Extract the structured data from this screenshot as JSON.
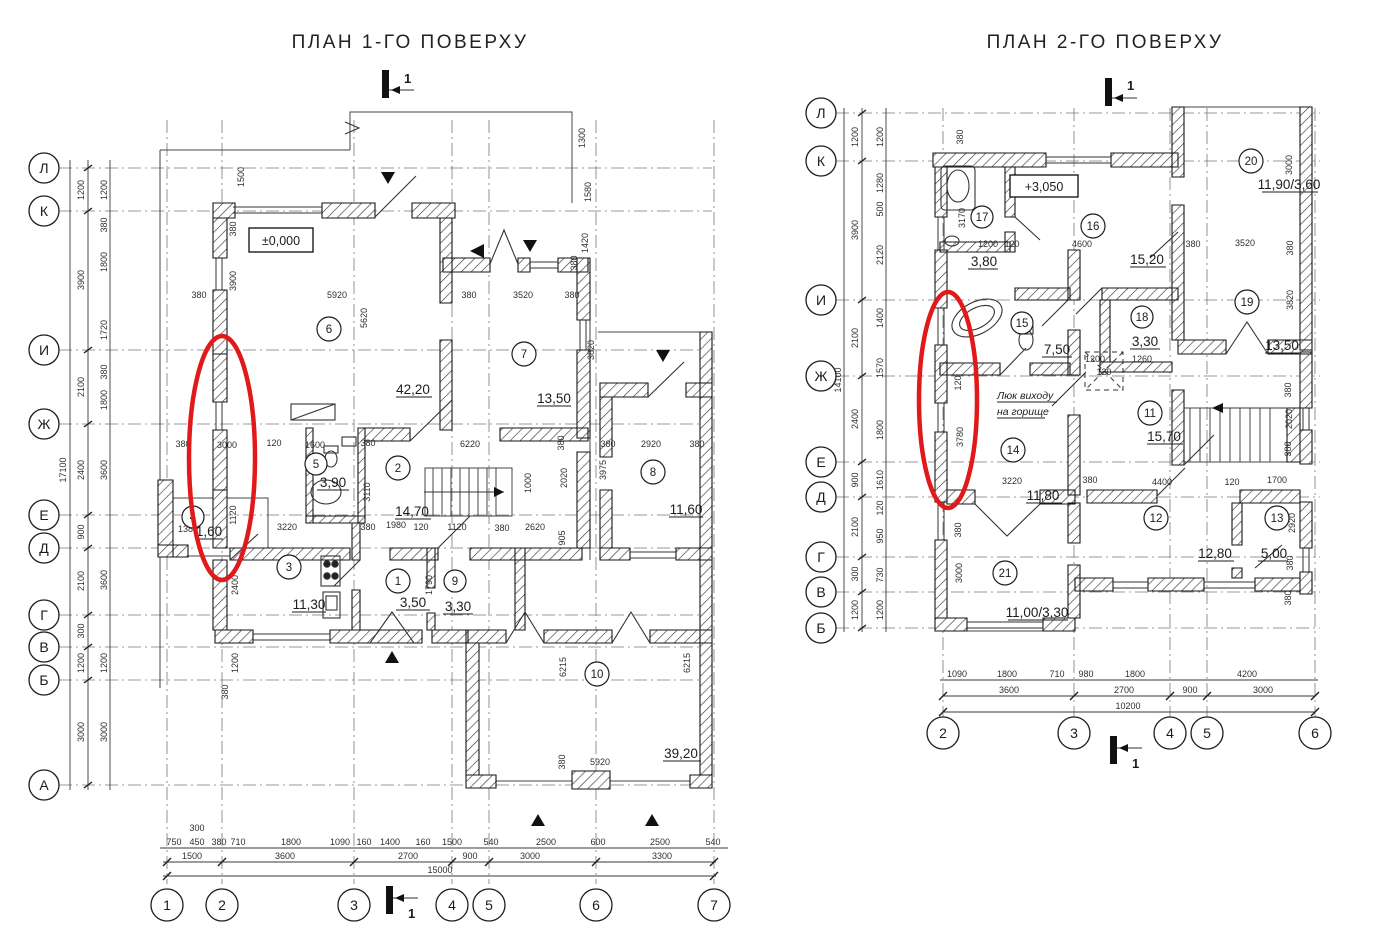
{
  "colors": {
    "highlight": "#e01a1a",
    "ink": "#1c1c1c"
  },
  "sec": "1",
  "L": {
    "title": "ПЛАН 1-ГО ПОВЕРХУ",
    "elev": "±0,000",
    "rows": [
      "Л",
      "К",
      "И",
      "Ж",
      "Е",
      "Д",
      "Г",
      "В",
      "Б",
      "А"
    ],
    "cols": [
      "1",
      "2",
      "3",
      "4",
      "5",
      "6",
      "7"
    ],
    "rooms": [
      {
        "num": "1",
        "area": "3,50"
      },
      {
        "num": "2",
        "area": "14,70"
      },
      {
        "num": "3",
        "area": "11,30"
      },
      {
        "num": "4",
        "area": "1,60"
      },
      {
        "num": "5",
        "area": "3,90"
      },
      {
        "num": "6",
        "area": "42,20"
      },
      {
        "num": "7",
        "area": "13,50"
      },
      {
        "num": "8",
        "area": "11,60"
      },
      {
        "num": "9",
        "area": "3,30"
      },
      {
        "num": "10",
        "area": "39,20"
      }
    ],
    "vo": [
      "1200",
      "3900",
      "2100",
      "2400",
      "900",
      "2100",
      "300",
      "1200",
      "3000"
    ],
    "vt": "17100",
    "vi": [
      "1200",
      "380",
      "1800",
      "1720",
      "380",
      "1800",
      "3600",
      "3600",
      "1200",
      "3000"
    ],
    "h1": [
      "750",
      "450",
      "380",
      "710",
      "1800",
      "1090",
      "160",
      "1400",
      "160",
      "1500",
      "540",
      "2500",
      "600",
      "2500",
      "540"
    ],
    "h1x": "300",
    "h2": [
      "1500",
      "3600",
      "2700",
      "900",
      "3000",
      "3300"
    ],
    "ht": "15000",
    "di": [
      "380",
      "5920",
      "380",
      "3520",
      "380",
      "3900",
      "5620",
      "1500",
      "380",
      "1300",
      "1580",
      "1420",
      "380",
      "3820",
      "380",
      "3000",
      "120",
      "1600",
      "380",
      "6220",
      "380",
      "2020",
      "1000",
      "1380",
      "3220",
      "380",
      "1980",
      "120",
      "1120",
      "380",
      "2620",
      "905",
      "2400",
      "1790",
      "380",
      "2920",
      "380",
      "3975",
      "6215",
      "6215",
      "380",
      "5920",
      "3110",
      "1200",
      "380",
      "1120"
    ]
  },
  "R": {
    "title": "ПЛАН 2-ГО ПОВЕРХУ",
    "elev": "+3,050",
    "note1": "Люк виходу",
    "note2": "на горище",
    "rows": [
      "Л",
      "К",
      "И",
      "Ж",
      "Е",
      "Д",
      "Г",
      "В",
      "Б"
    ],
    "cols": [
      "2",
      "3",
      "4",
      "5",
      "6"
    ],
    "rooms": [
      {
        "num": "11",
        "area": "15,70"
      },
      {
        "num": "12",
        "area": "12,80"
      },
      {
        "num": "13",
        "area": "5,00"
      },
      {
        "num": "14",
        "area": "11,80"
      },
      {
        "num": "15",
        "area": "7,50"
      },
      {
        "num": "16",
        "area": "15,20"
      },
      {
        "num": "17",
        "area": "3,80"
      },
      {
        "num": "18",
        "area": "3,30"
      },
      {
        "num": "19",
        "area": "13,50"
      },
      {
        "num": "20",
        "area": "11,90/3,60"
      },
      {
        "num": "21",
        "area": "11,00/3,30"
      }
    ],
    "vo": [
      "1200",
      "3900",
      "2100",
      "2400",
      "900",
      "2100",
      "300",
      "1200"
    ],
    "vt": "14100",
    "vi": [
      "1200",
      "1280",
      "500",
      "2120",
      "1400",
      "1570",
      "1800",
      "1610",
      "120",
      "950",
      "730",
      "1200"
    ],
    "h1": [
      "1090",
      "1800",
      "710",
      "980",
      "1800",
      "4200"
    ],
    "h2": [
      "3600",
      "2700",
      "900",
      "3000"
    ],
    "ht": "10200",
    "di": [
      "380",
      "3170",
      "1200",
      "120",
      "4600",
      "380",
      "3520",
      "380",
      "3000",
      "3820",
      "1200",
      "1260",
      "120",
      "3780",
      "120",
      "3220",
      "380",
      "4400",
      "120",
      "1700",
      "2020",
      "380",
      "380",
      "380",
      "3000",
      "2920",
      "380",
      "380"
    ]
  }
}
